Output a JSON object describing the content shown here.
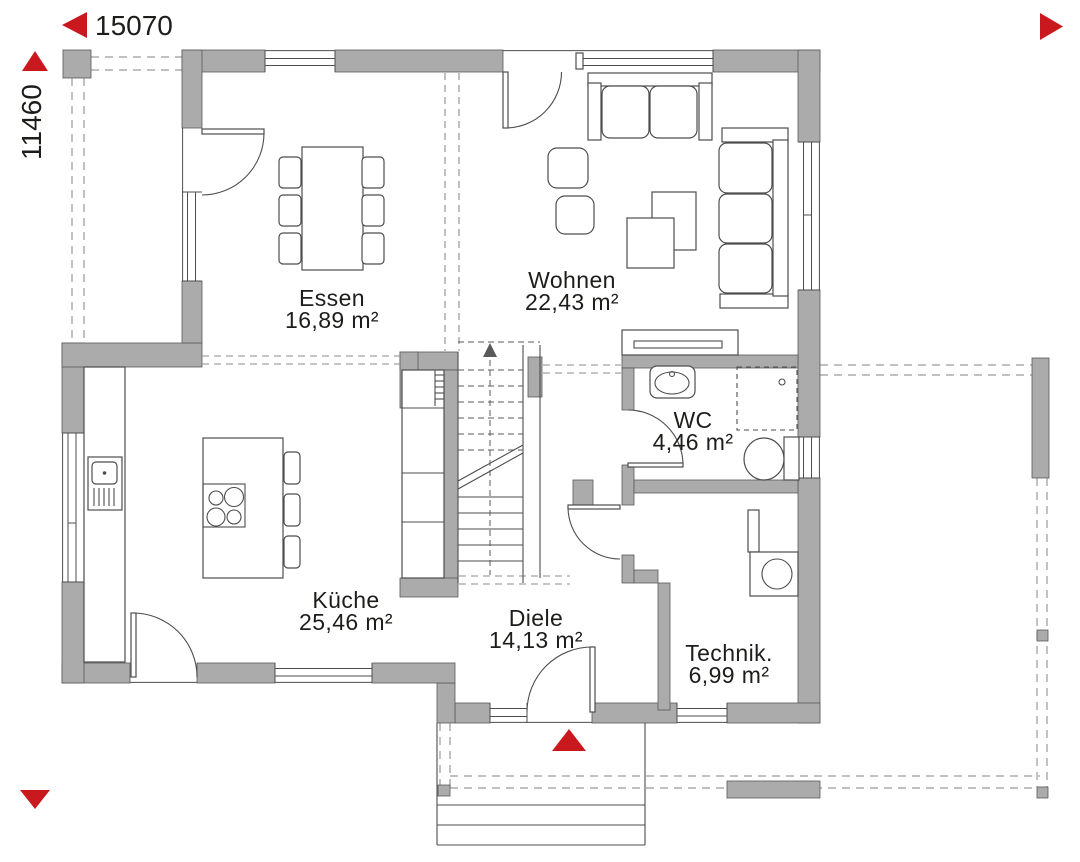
{
  "dimensions": {
    "horizontal": "15070",
    "vertical": "11460"
  },
  "rooms": {
    "essen": {
      "name": "Essen",
      "area": "16,89 m²"
    },
    "wohnen": {
      "name": "Wohnen",
      "area": "22,43 m²"
    },
    "wc": {
      "name": "WC",
      "area": "4,46 m²"
    },
    "kueche": {
      "name": "Küche",
      "area": "25,46 m²"
    },
    "diele": {
      "name": "Diele",
      "area": "14,13 m²"
    },
    "technik": {
      "name": "Technik.",
      "area": "6,99 m²"
    }
  },
  "colors": {
    "wall_fill": "#ababab",
    "line": "#4d4d4d",
    "accent_red": "#c9191e",
    "text": "#1d1d1b",
    "dash": "#9a9a9a"
  },
  "icons": {
    "dimension_arrow_left": "left-triangle",
    "dimension_arrow_up": "up-triangle",
    "dimension_arrow_right": "right-triangle",
    "dimension_arrow_down": "down-triangle",
    "entrance_arrow": "up-triangle"
  }
}
